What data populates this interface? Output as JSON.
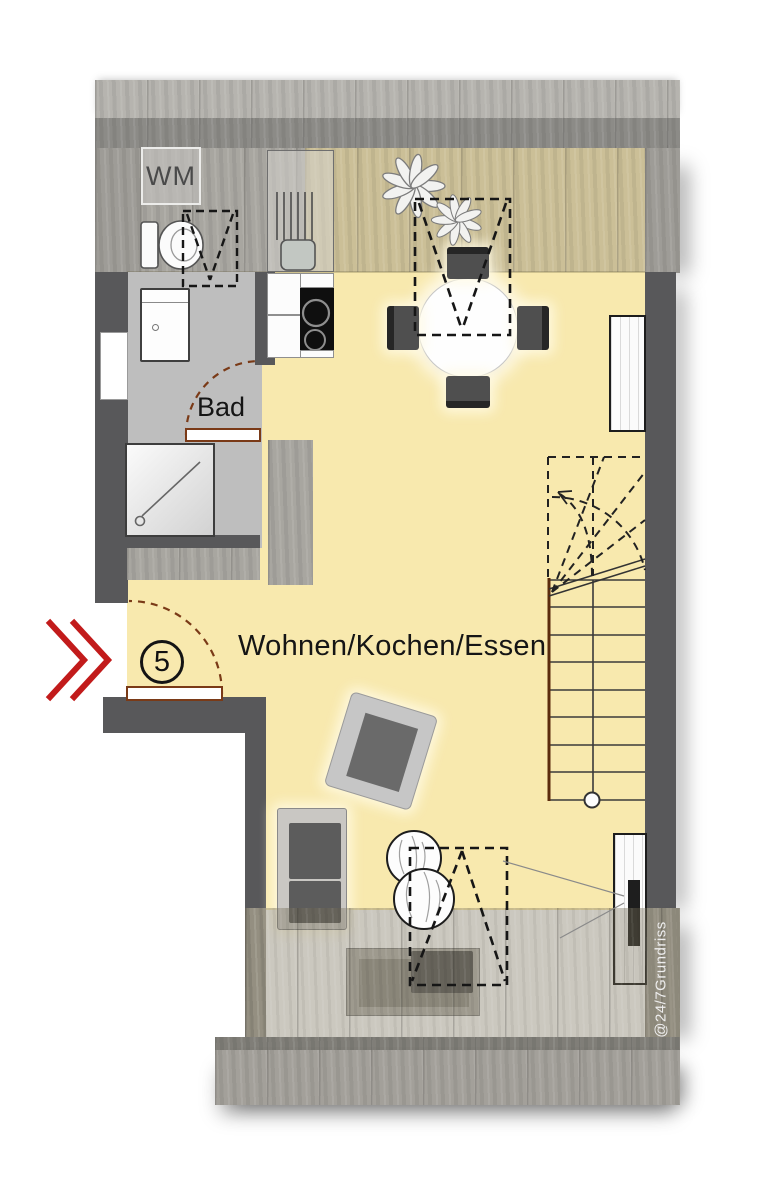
{
  "plan": {
    "unit_number": "5",
    "watermark": "@24/7Grundriss",
    "room_labels": {
      "bathroom": "Bad",
      "main": "Wohnen/Kochen/Essen"
    },
    "appliance_labels": {
      "washing_machine": "WM"
    },
    "colors": {
      "floor_yellow": "#F8E9AE",
      "bathroom_floor_gray": "#BEBEBE",
      "wall_dark_gray": "#58585A",
      "wood_band_gray": "#A3A19C",
      "entry_arrow_red": "#C21B1B",
      "door_brown": "#7A3A17",
      "dashed_line_black": "#161616",
      "watermark_white": "#EDEDED"
    }
  }
}
